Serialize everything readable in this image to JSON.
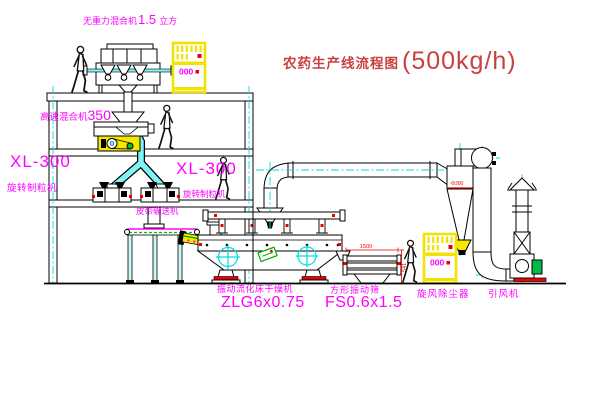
{
  "title": {
    "name": "农药生产线流程图",
    "capacity": "(500kg/h)"
  },
  "labels": {
    "gravity_mixer": {
      "name": "无重力混合机",
      "num": "1.5",
      "unit": "立方"
    },
    "high_speed_mixer": {
      "name": "高速混合机",
      "num": "350"
    },
    "granulator_left": {
      "model": "XL-300",
      "name": "旋转制粒机"
    },
    "granulator_right": {
      "model": "XL-300",
      "name": "旋转制粒机"
    },
    "belt_conveyor": {
      "name": "皮带输送机"
    },
    "dryer": {
      "name": "振动流化床干燥机",
      "model": "ZLG6x0.75"
    },
    "screen": {
      "name": "方形振动筛",
      "model": "FS0.6x1.5"
    },
    "cyclone": {
      "name": "旋风除尘器",
      "dim": "Φ300"
    },
    "fan": {
      "name": "引风机"
    },
    "cabinet": {
      "display": "000"
    },
    "dims": {
      "width": "1500",
      "height": "541"
    }
  },
  "colors": {
    "magenta": "#ff00ff",
    "cyan": "#00dddd",
    "yellow": "#f5e800",
    "red": "#ee0000",
    "green": "#00aa44",
    "title_red": "#c84040",
    "line": "#000000"
  }
}
